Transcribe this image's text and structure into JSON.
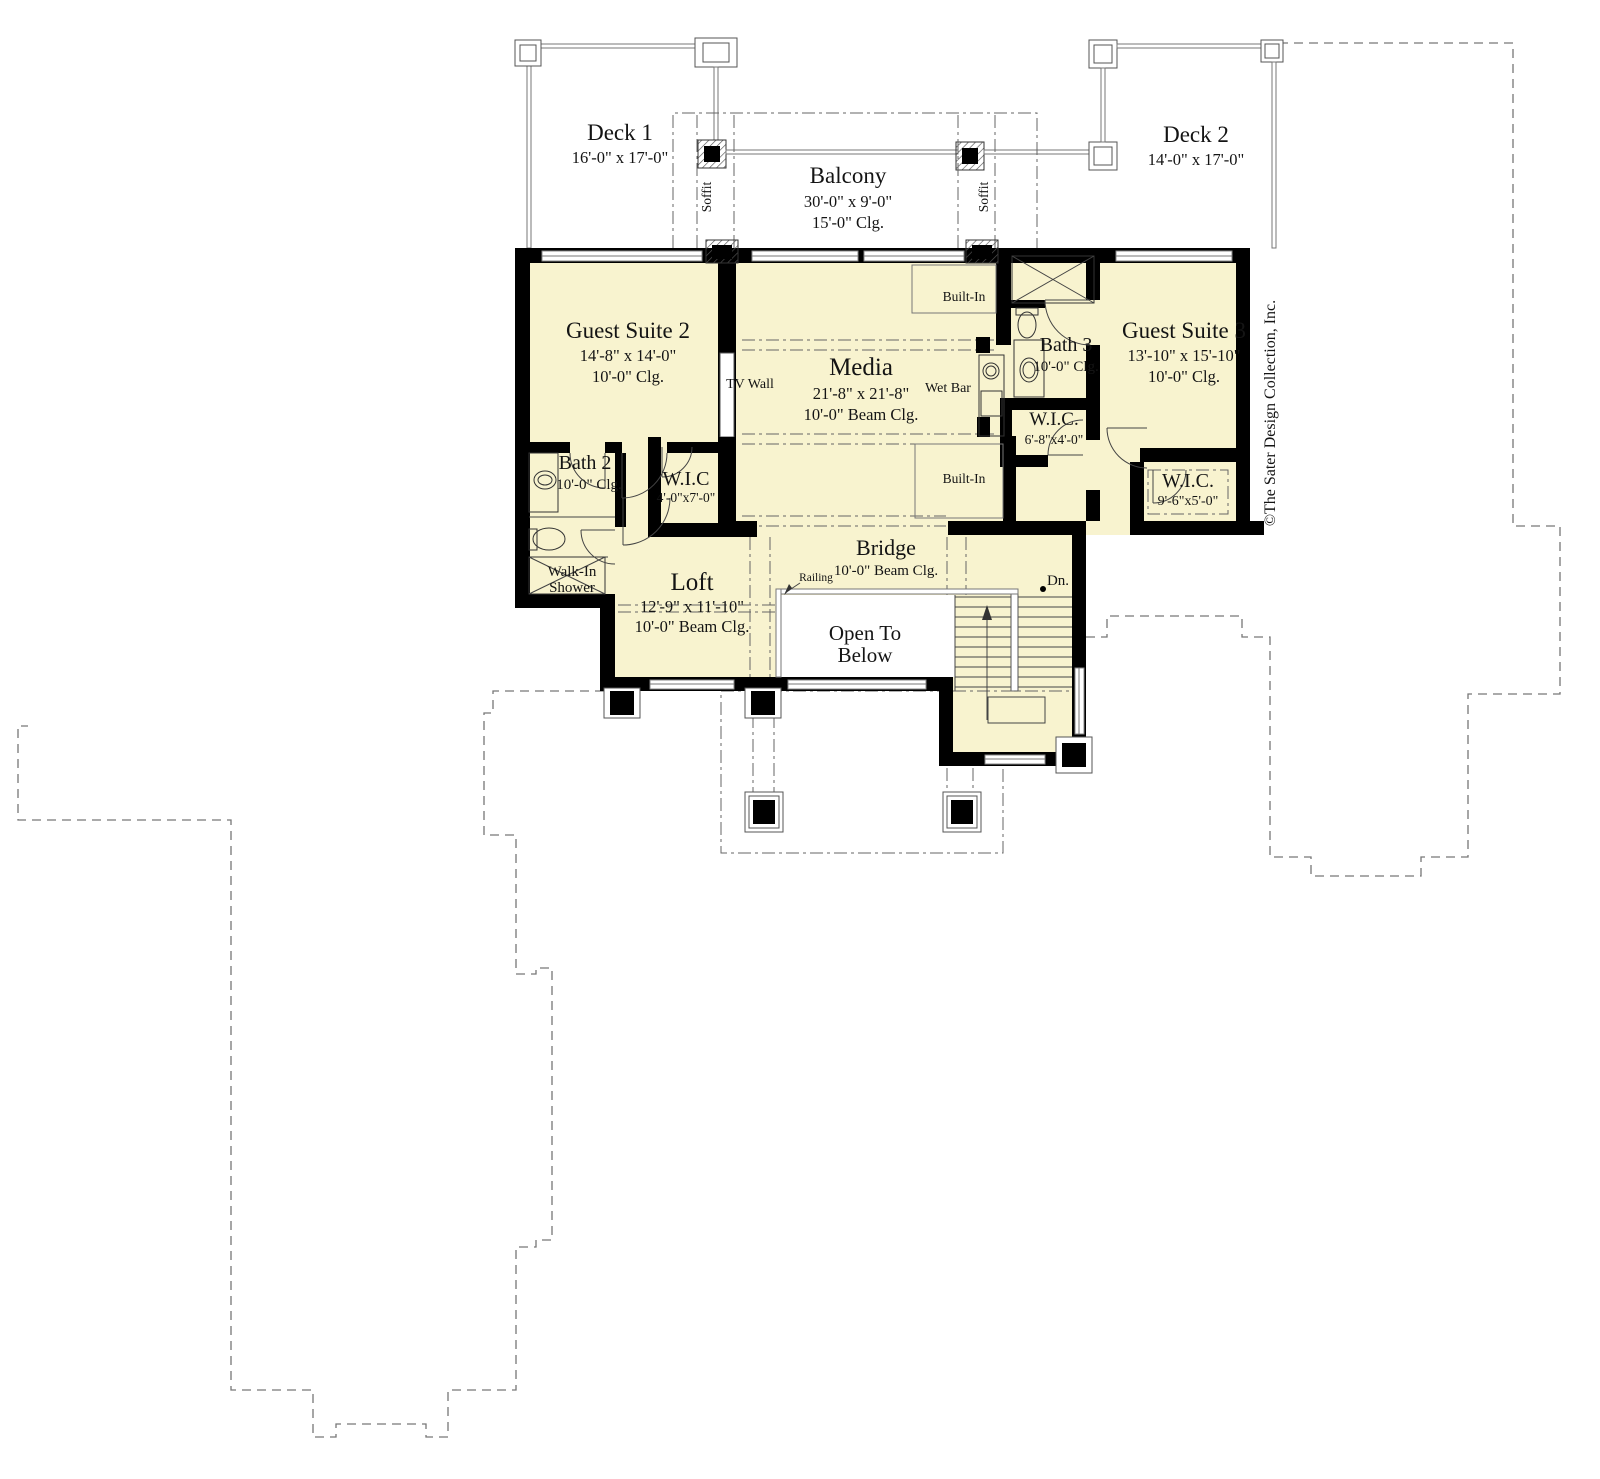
{
  "plan": {
    "copyright": "©The Sater Design Collection, Inc.",
    "colors": {
      "room_fill": "#f8f3cf",
      "wall": "#000000",
      "outline": "#777777"
    }
  },
  "areas": {
    "deck1": {
      "name": "Deck 1",
      "dims": "16'-0\" x 17'-0\""
    },
    "balcony": {
      "name": "Balcony",
      "dims": "30'-0\" x 9'-0\"",
      "ceiling": "15'-0\" Clg."
    },
    "deck2": {
      "name": "Deck 2",
      "dims": "14'-0\" x 17'-0\""
    },
    "guest_suite2": {
      "name": "Guest Suite 2",
      "dims": "14'-8\" x 14'-0\"",
      "ceiling": "10'-0\" Clg."
    },
    "media": {
      "name": "Media",
      "dims": "21'-8\" x 21'-8\"",
      "ceiling": "10'-0\" Beam Clg."
    },
    "guest_suite3": {
      "name": "Guest Suite 3",
      "dims": "13'-10\" x 15'-10\"",
      "ceiling": "10'-0\" Clg."
    },
    "bath2": {
      "name": "Bath 2",
      "ceiling": "10'-0\" Clg."
    },
    "bath3": {
      "name": "Bath 3",
      "ceiling": "10'-0\" Clg."
    },
    "wic1": {
      "name": "W.I.C",
      "dims": "4'-0\"x7'-0\""
    },
    "wic2": {
      "name": "W.I.C.",
      "dims": "6'-8\"x4'-0\""
    },
    "wic3": {
      "name": "W.I.C.",
      "dims": "9'-6\"x5'-0\""
    },
    "loft": {
      "name": "Loft",
      "dims": "12'-9\" x 11'-10\"",
      "ceiling": "10'-0\" Beam Clg."
    },
    "bridge": {
      "name": "Bridge",
      "ceiling": "10'-0\" Beam Clg."
    },
    "open_to_below": {
      "line1": "Open To",
      "line2": "Below"
    },
    "walk_in_shower": {
      "line1": "Walk-In",
      "line2": "Shower"
    }
  },
  "labels": {
    "tv_wall": "TV Wall",
    "wet_bar": "Wet Bar",
    "built_in_top": "Built-In",
    "built_in_bottom": "Built-In",
    "soffit_left": "Soffit",
    "soffit_right": "Soffit",
    "railing": "Railing",
    "down": "Dn."
  }
}
